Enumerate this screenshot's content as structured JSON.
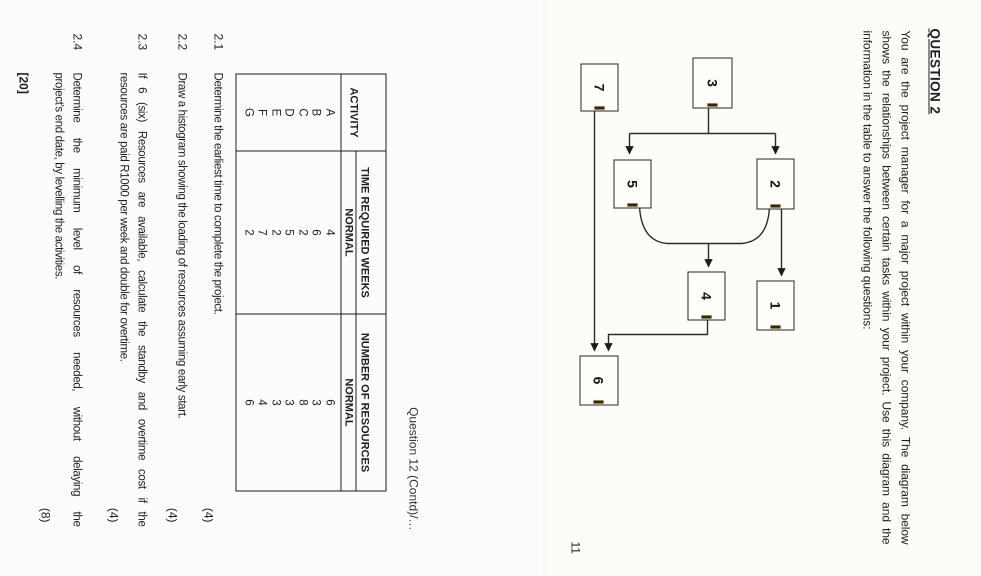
{
  "page11": {
    "title": "QUESTION 2",
    "intro_lines": [
      "You are the project manager for a major project within your company.  The diagram below",
      "shows the relationships between certain tasks within your project.  Use this diagram and the",
      "information in the table to answer the following questions:"
    ],
    "page_number": "11",
    "diagram": {
      "type": "precedence-network",
      "nodes": [
        {
          "id": "3",
          "label": "3",
          "x": 57,
          "y": 249,
          "w": 49,
          "h": 38
        },
        {
          "id": "2",
          "label": "2",
          "x": 158,
          "y": 187,
          "w": 49,
          "h": 36
        },
        {
          "id": "1",
          "label": "1",
          "x": 280,
          "y": 187,
          "w": 48,
          "h": 36
        },
        {
          "id": "5",
          "label": "5",
          "x": 159,
          "y": 330,
          "w": 47,
          "h": 36
        },
        {
          "id": "4",
          "label": "4",
          "x": 271,
          "y": 256,
          "w": 47,
          "h": 36
        },
        {
          "id": "7",
          "label": "7",
          "x": 63,
          "y": 363,
          "w": 46,
          "h": 36
        },
        {
          "id": "6",
          "label": "6",
          "x": 355,
          "y": 363,
          "w": 48,
          "h": 37
        }
      ],
      "edges": [
        {
          "from": "3",
          "to": "2"
        },
        {
          "from": "3",
          "to": "5"
        },
        {
          "from": "2",
          "to": "1"
        },
        {
          "from": "2",
          "to": "4"
        },
        {
          "from": "5",
          "to": "4"
        },
        {
          "from": "4",
          "to": "6"
        },
        {
          "from": "7",
          "to": "6"
        }
      ]
    }
  },
  "page12": {
    "contd_note": "Question 12 (Contd)/…",
    "table": {
      "col_activity": "ACTIVITY",
      "col_time": "TIME REQUIRED WEEKS",
      "col_resources": "NUMBER OF RESOURCES",
      "sub_normal_time": "NORMAL",
      "sub_normal_resources": "NORMAL",
      "rows": [
        {
          "activity": "A",
          "time": "4",
          "resources": "6"
        },
        {
          "activity": "B",
          "time": "6",
          "resources": "3"
        },
        {
          "activity": "C",
          "time": "2",
          "resources": "8"
        },
        {
          "activity": "D",
          "time": "5",
          "resources": "3"
        },
        {
          "activity": "E",
          "time": "2",
          "resources": "3"
        },
        {
          "activity": "F",
          "time": "7",
          "resources": "4"
        },
        {
          "activity": "G",
          "time": "2",
          "resources": "6"
        }
      ]
    },
    "questions": [
      {
        "number": "2.1",
        "lines": [
          "Determine the earliest time to complete the project."
        ],
        "marks": "(4)"
      },
      {
        "number": "2.2",
        "lines": [
          "Draw a histogram showing the loading of resources assuming early start."
        ],
        "marks": "(4)"
      },
      {
        "number": "2.3",
        "lines": [
          "If 6 (six) Resources are available, calculate the standby and overtime cost if the",
          "resources are paid R1000 per week and double for overtime."
        ],
        "marks": "(4)"
      },
      {
        "number": "2.4",
        "lines": [
          "Determine  the  minimum  level  of  resources  needed,  without  delaying  the",
          "project's end date, by levelling the activities."
        ],
        "marks": "(8)"
      }
    ],
    "total_marks": "[20]"
  }
}
